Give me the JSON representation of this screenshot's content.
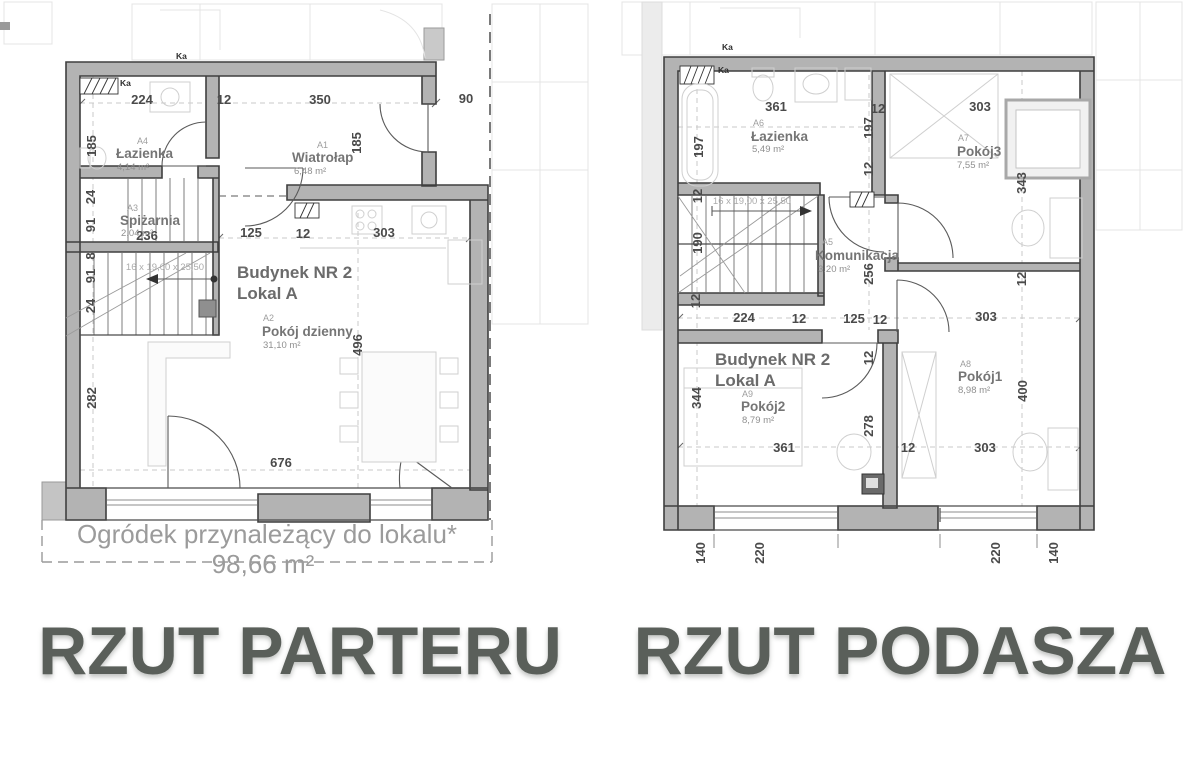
{
  "titles": {
    "left": "RZUT PARTERU",
    "right": "RZUT PODASZA"
  },
  "colors": {
    "wall_fill": "#b3b3b3",
    "wall_stroke": "#3f3f3f",
    "dim_text": "#4a4a4a",
    "room_text": "#757575",
    "muted_text": "#9b9b9b",
    "title_text": "#5a5f5a"
  },
  "left_plan": {
    "building": "Budynek NR 2",
    "unit": "Lokal A",
    "ka_top": "Ka",
    "ka_inner": "Ka",
    "stairs_label": "16 x 19,00 x 25,50",
    "garden_label": "Ogródek przynależący do lokalu*",
    "garden_area": "98,66 m²",
    "rooms": {
      "a4": {
        "code": "A4",
        "name": "Łazienka",
        "area": "4,14 m²"
      },
      "a1": {
        "code": "A1",
        "name": "Wiatrołap",
        "area": "6,48 m²"
      },
      "a3": {
        "code": "A3",
        "name": "Spiżarnia",
        "area": "2,04 m²"
      },
      "a2": {
        "code": "A2",
        "name": "Pokój dzienny",
        "area": "31,10 m²"
      }
    },
    "dims": {
      "top": [
        "224",
        "12",
        "350",
        "90"
      ],
      "left": [
        "185",
        "24",
        "91",
        "8",
        "91",
        "24",
        "282"
      ],
      "right": [
        "185"
      ],
      "mid": [
        "236",
        "125",
        "12",
        "303"
      ],
      "v": [
        "496"
      ],
      "bottom": [
        "676"
      ]
    }
  },
  "right_plan": {
    "building": "Budynek NR 2",
    "unit": "Lokal A",
    "ka_top": "Ka",
    "ka_inner": "Ka",
    "stairs_label": "16 x 19,00 x 25,50",
    "rooms": {
      "a6": {
        "code": "A6",
        "name": "Łazienka",
        "area": "5,49 m²"
      },
      "a7": {
        "code": "A7",
        "name": "Pokój3",
        "area": "7,55 m²"
      },
      "a5": {
        "code": "A5",
        "name": "Komunikacja",
        "area": "3,20 m²"
      },
      "a9": {
        "code": "A9",
        "name": "Pokój2",
        "area": "8,79 m²"
      },
      "a8": {
        "code": "A8",
        "name": "Pokój1",
        "area": "8,98 m²"
      }
    },
    "dims": {
      "top": [
        "361",
        "12",
        "303"
      ],
      "left": [
        "197",
        "12",
        "190",
        "12",
        "344"
      ],
      "mid": [
        "197",
        "12",
        "256",
        "12",
        "278"
      ],
      "right": [
        "343",
        "12",
        "400"
      ],
      "row": [
        "224",
        "12",
        "125",
        "12",
        "303"
      ],
      "lower": [
        "361",
        "12",
        "303"
      ],
      "bottom": [
        "140",
        "220",
        "220",
        "140"
      ]
    }
  }
}
